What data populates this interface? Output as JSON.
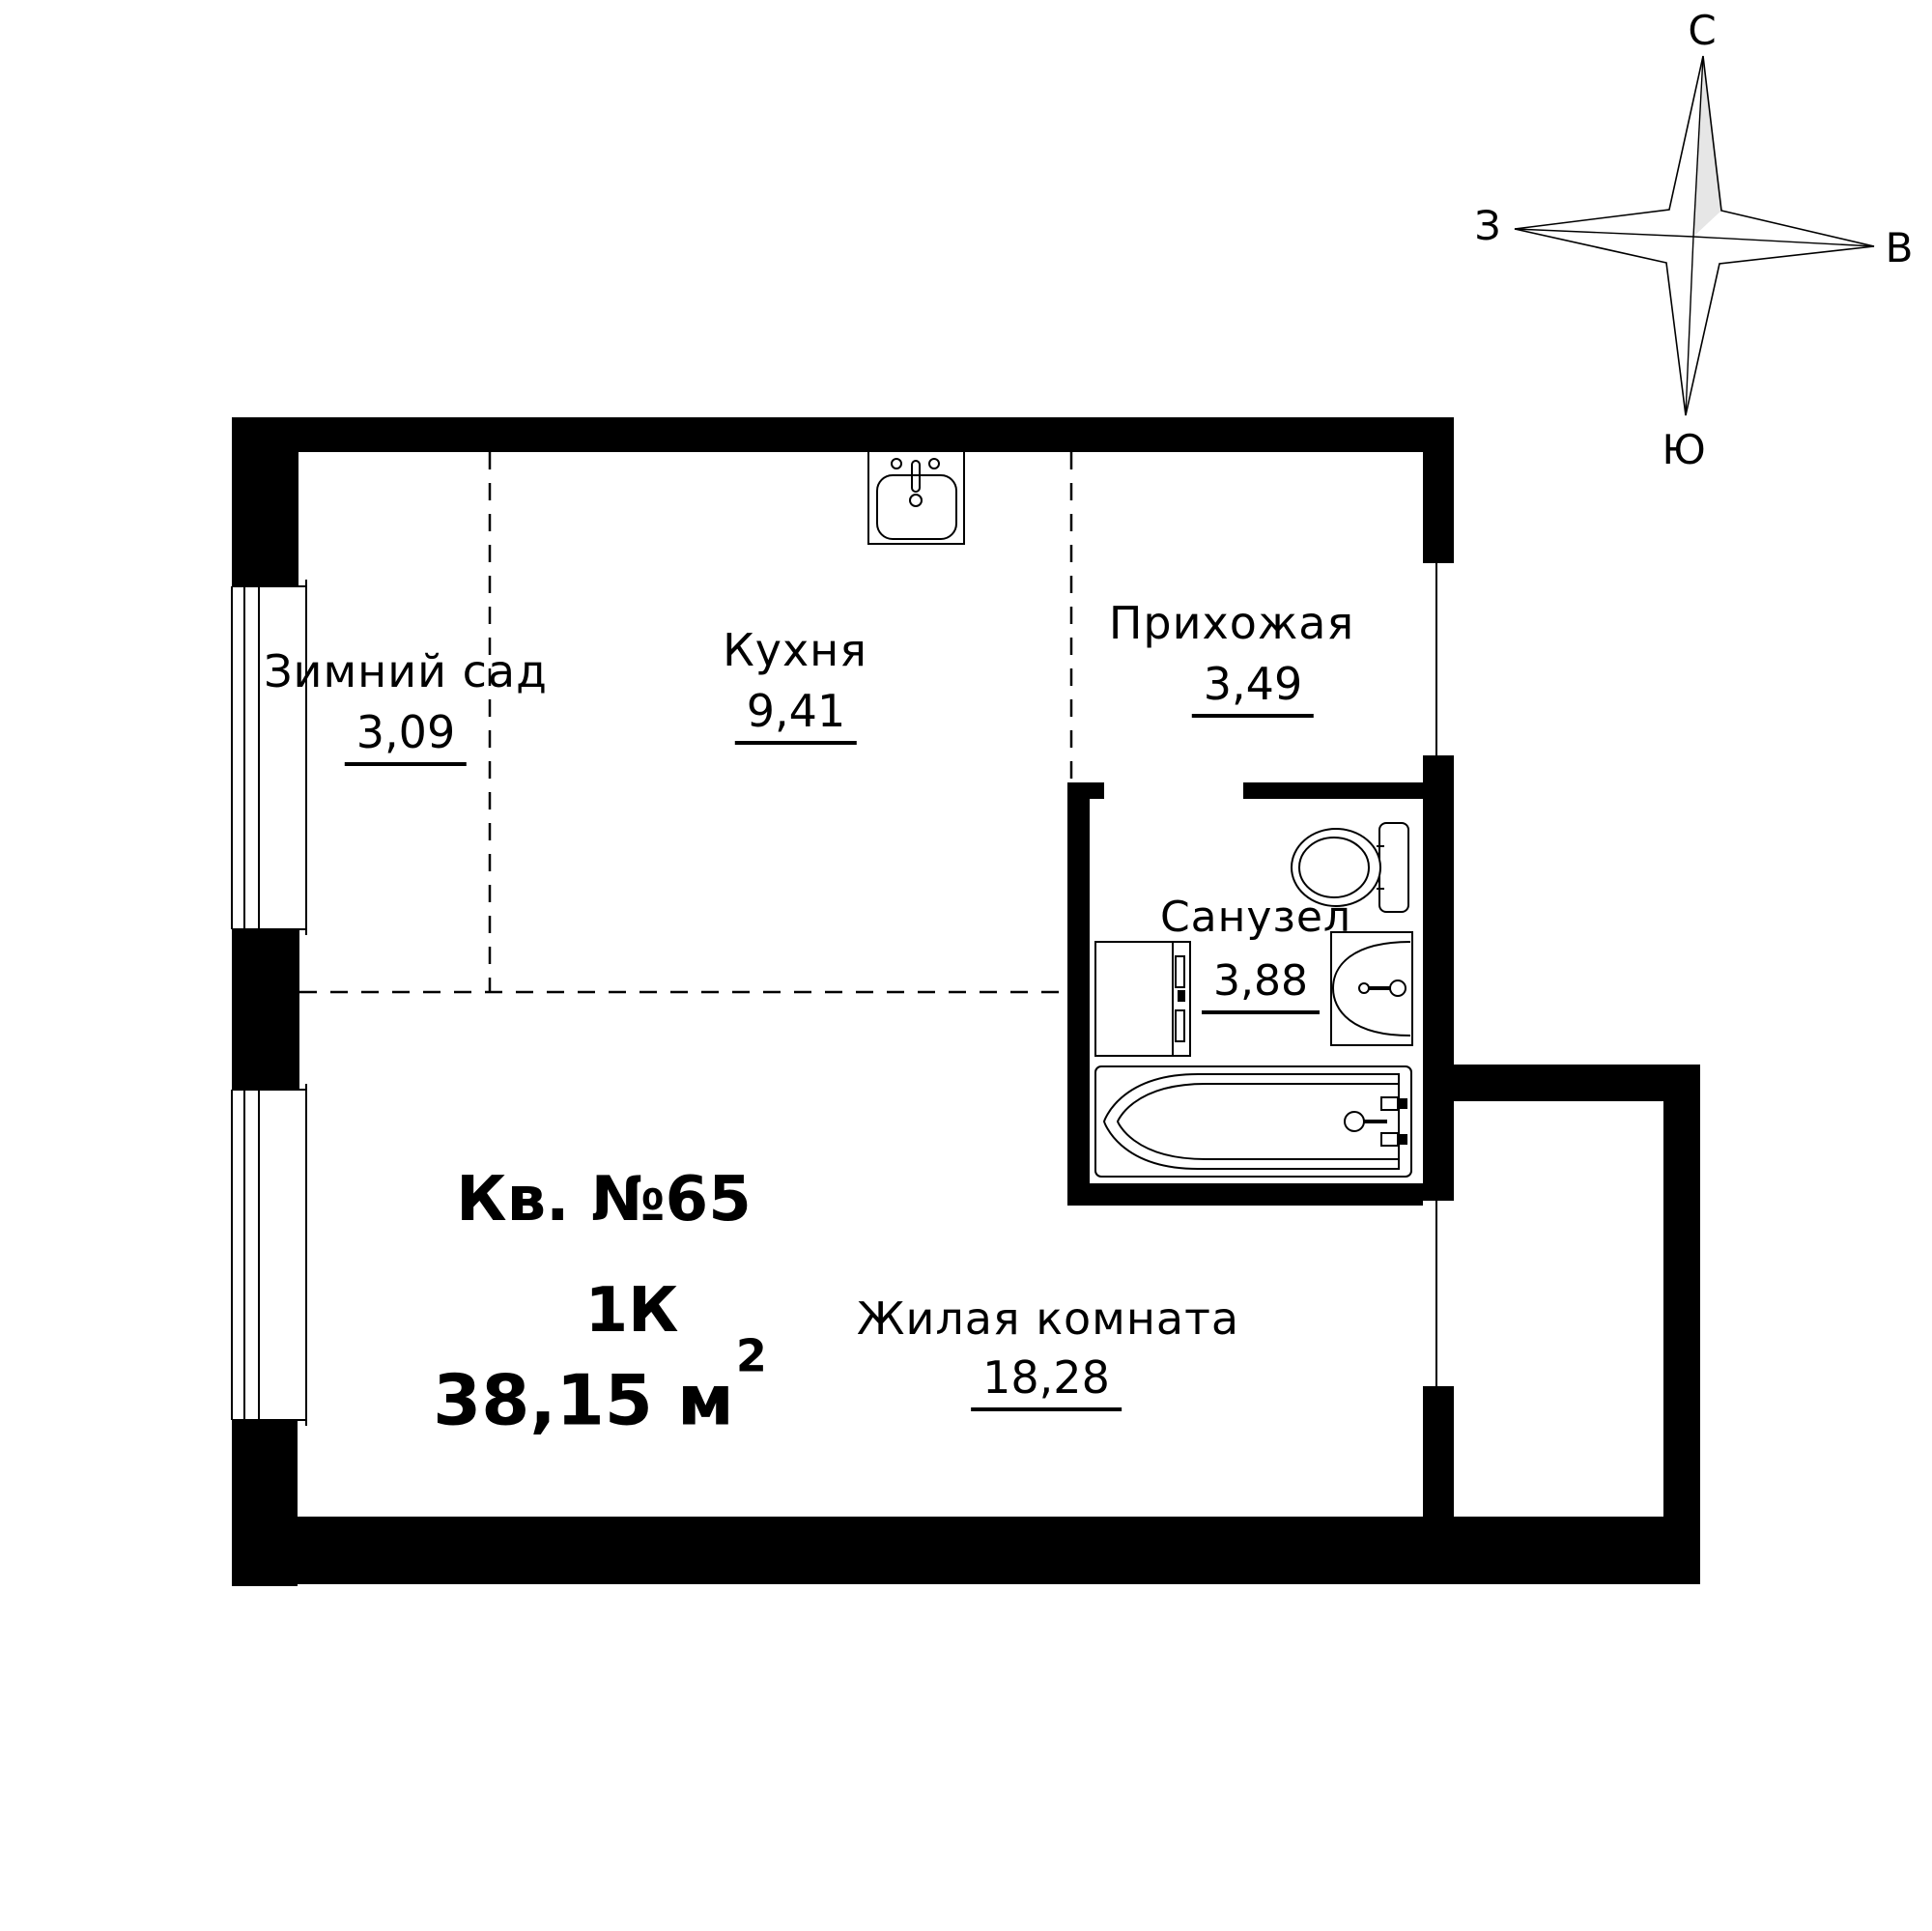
{
  "apartment": {
    "number": "Кв. №65",
    "rooms_type": "1К",
    "total_area": "38,15 м",
    "total_area_sup": "2"
  },
  "rooms": [
    {
      "id": "winter-garden",
      "name": "Зимний сад",
      "area": "3,09"
    },
    {
      "id": "kitchen",
      "name": "Кухня",
      "area": "9,41"
    },
    {
      "id": "hallway",
      "name": "Прихожая",
      "area": "3,49"
    },
    {
      "id": "bathroom",
      "name": "Санузел",
      "area": "3,88"
    },
    {
      "id": "living-room",
      "name": "Жилая комната",
      "area": "18,28"
    }
  ],
  "compass": {
    "north": "С",
    "south": "Ю",
    "west": "З",
    "east": "В"
  },
  "fixtures": [
    "kitchen-sink-icon",
    "toilet-icon",
    "washing-machine-icon",
    "washbasin-icon",
    "bathtub-icon"
  ],
  "colors": {
    "walls": "#000000",
    "background": "#ffffff",
    "compass_shade": "#e6e6e6",
    "lines": "#000000"
  }
}
